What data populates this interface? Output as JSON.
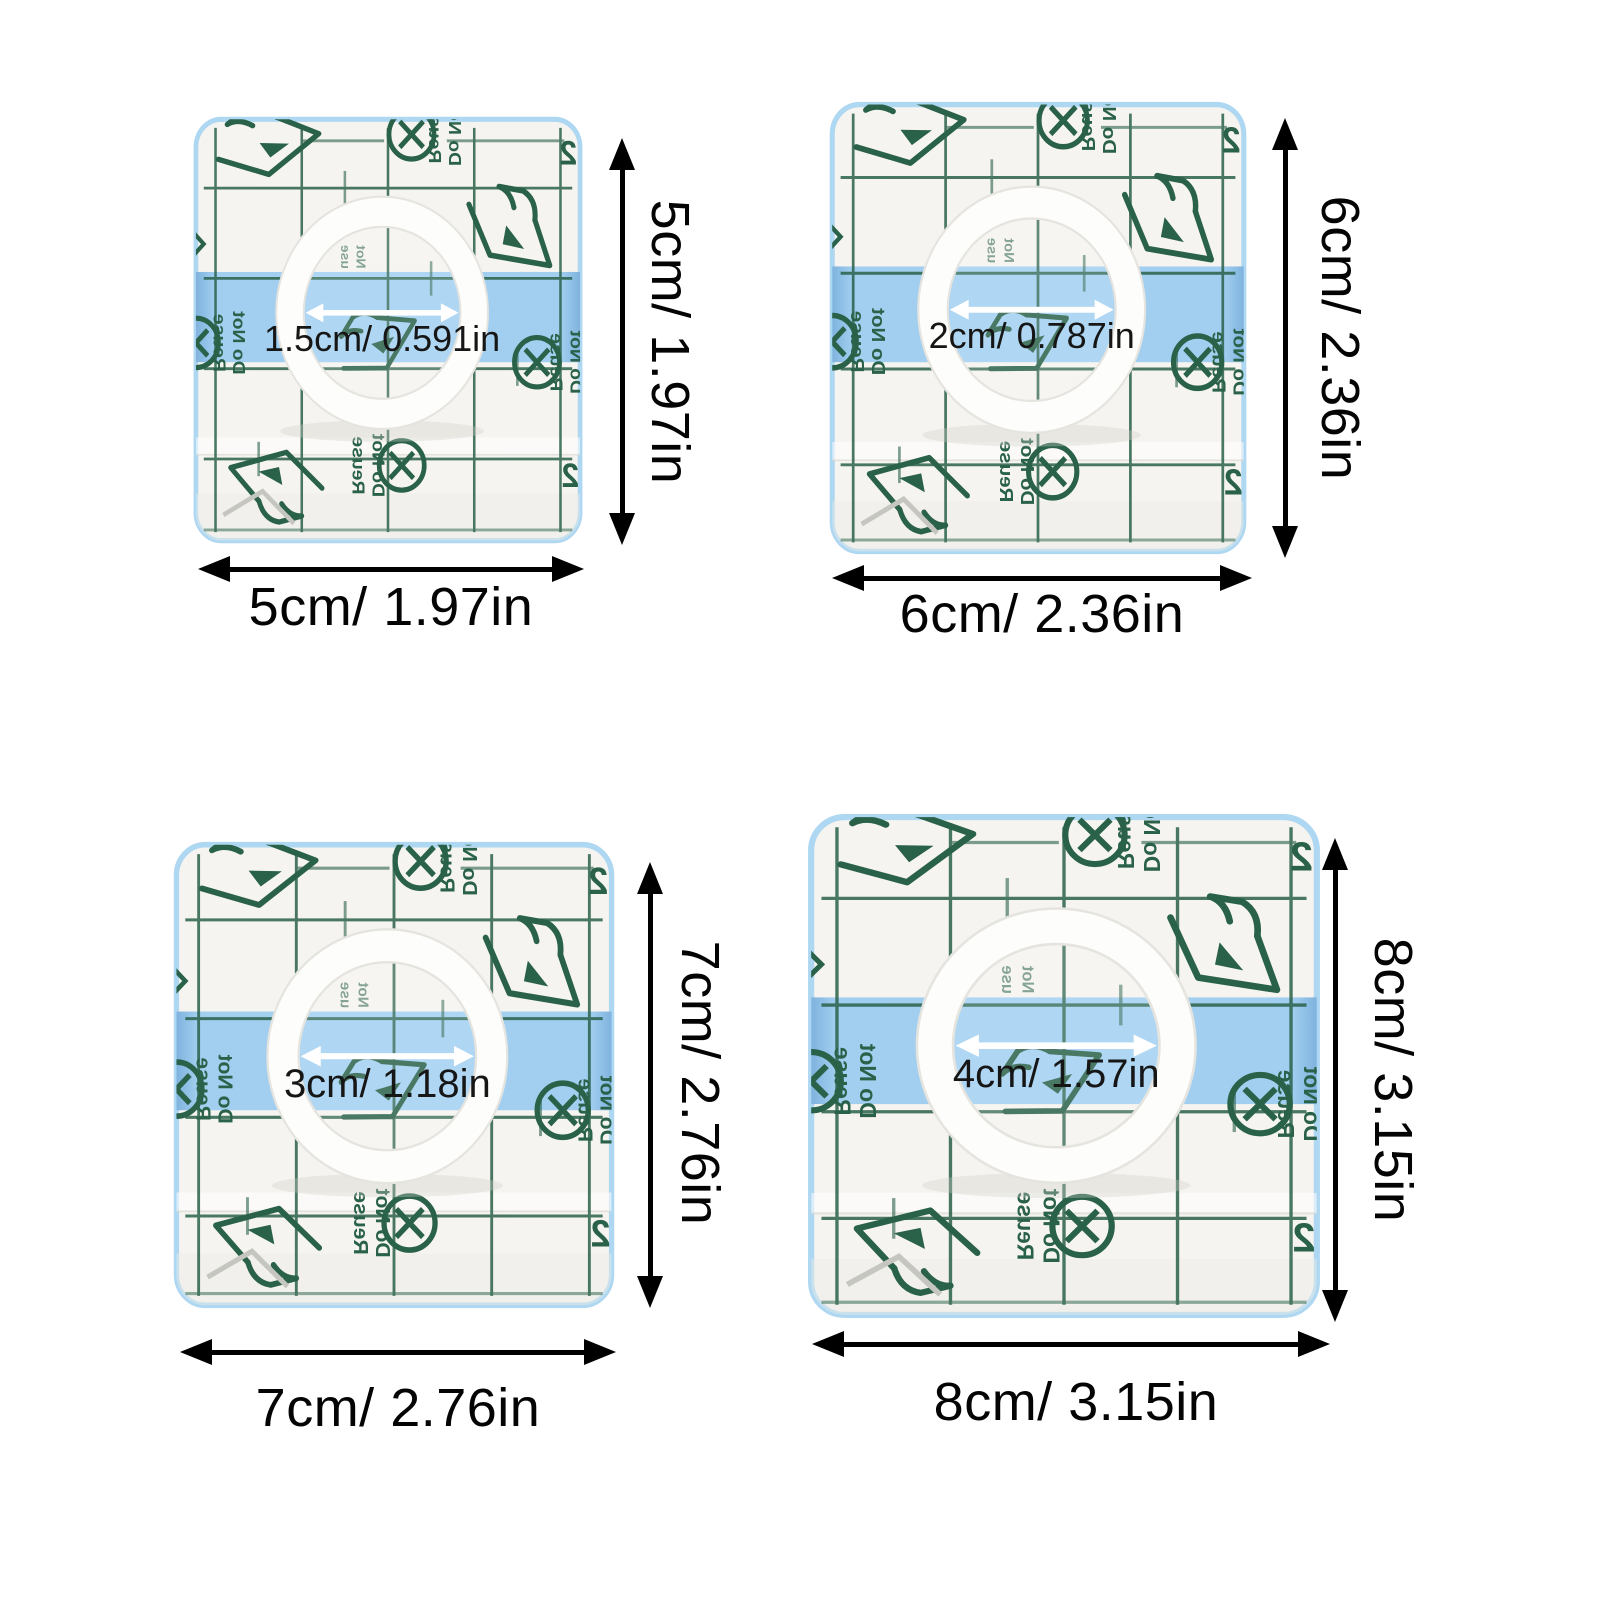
{
  "patches": [
    {
      "id": "patch-5cm",
      "size_label": "5cm/ 1.97in",
      "hole_label": "1.5cm/ 0.591in"
    },
    {
      "id": "patch-6cm",
      "size_label": "6cm/ 2.36in",
      "hole_label": "2cm/ 0.787in"
    },
    {
      "id": "patch-7cm",
      "size_label": "7cm/ 2.76in",
      "hole_label": "3cm/ 1.18in"
    },
    {
      "id": "patch-8cm",
      "size_label": "8cm/ 3.15in",
      "hole_label": "4cm/ 1.57in"
    }
  ],
  "print_marks": {
    "do_not": "Do Not",
    "reuse": "Reuse",
    "not": "Not",
    "use": "use",
    "corner_mark": "2"
  },
  "colors": {
    "page_bg": "#ffffff",
    "patch_bg": "#f6f4f0",
    "patch_edge_blue": "#aed7f2",
    "grid_green": "#2a6149",
    "band_blue": "#a2cff0",
    "band_edge_blue": "#7fb3de",
    "ring_white": "#fdfdfb",
    "dimension_black": "#000000",
    "hole_arrow_white": "#ffffff",
    "ghost_gray": "#c6c6c0"
  }
}
